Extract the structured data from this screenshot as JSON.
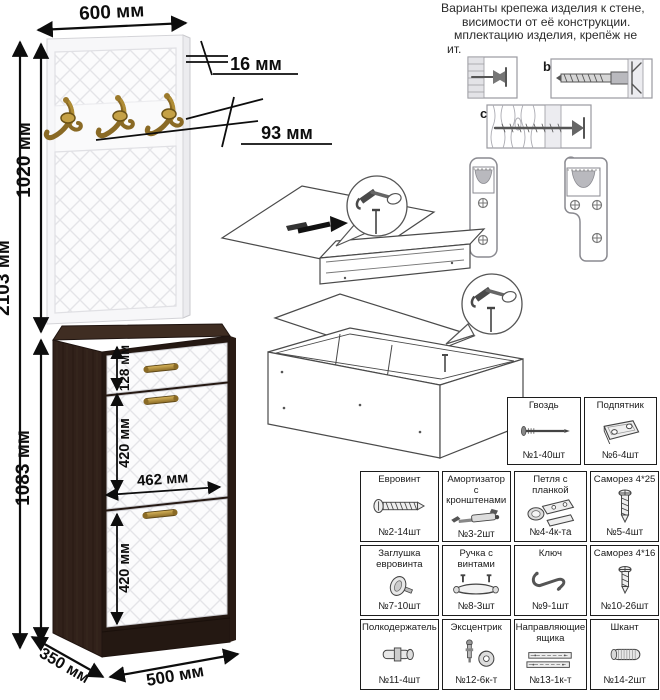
{
  "note": {
    "lines": [
      "Варианты крепежа изделия к стене,",
      "висимости от её конструкции.",
      "мплектацию изделия, крепёж не",
      "ит."
    ]
  },
  "wall_variants": {
    "b": "b",
    "c": "c"
  },
  "dims": {
    "width_top": "600 мм",
    "panel_thickness": "16 мм",
    "hook_offset": "93 мм",
    "panel_height": "1020 мм",
    "total_height": "2103 мм",
    "cabinet_height": "1083 мм",
    "drawer_front": "128 мм",
    "flap_upper": "420 мм",
    "front_width": "462 мм",
    "flap_lower": "420 мм",
    "depth": "350 мм",
    "cabinet_width": "500 мм"
  },
  "hardware_top": [
    {
      "name": "Гвоздь",
      "qty": "№1-40шт"
    },
    {
      "name": "Подпятник",
      "qty": "№6-4шт"
    }
  ],
  "hardware": [
    {
      "name": "Евровинт",
      "qty": "№2-14шт"
    },
    {
      "name": "Амортизатор с кронштенами",
      "qty": "№3-2шт"
    },
    {
      "name": "Петля с планкой",
      "qty": "№4-4к-та"
    },
    {
      "name": "Саморез 4*25",
      "qty": "№5-4шт"
    },
    {
      "name": "Заглушка евровинта",
      "qty": "№7-10шт"
    },
    {
      "name": "Ручка с винтами",
      "qty": "№8-3шт"
    },
    {
      "name": "Ключ",
      "qty": "№9-1шт"
    },
    {
      "name": "Саморез 4*16",
      "qty": "№10-26шт"
    },
    {
      "name": "Полкодержатель",
      "qty": "№11-4шт"
    },
    {
      "name": "Эксцентрик",
      "qty": "№12-6к-т"
    },
    {
      "name": "Направляющие ящика",
      "qty": "№13-1к-т"
    },
    {
      "name": "Шкант",
      "qty": "№14-2шт"
    }
  ],
  "colors": {
    "wenge": "#31211a",
    "front_white": "#fbfbfc",
    "brass": "#a8852f",
    "line": "#0d0d0d",
    "pattern_line": "#e4e4e8"
  }
}
